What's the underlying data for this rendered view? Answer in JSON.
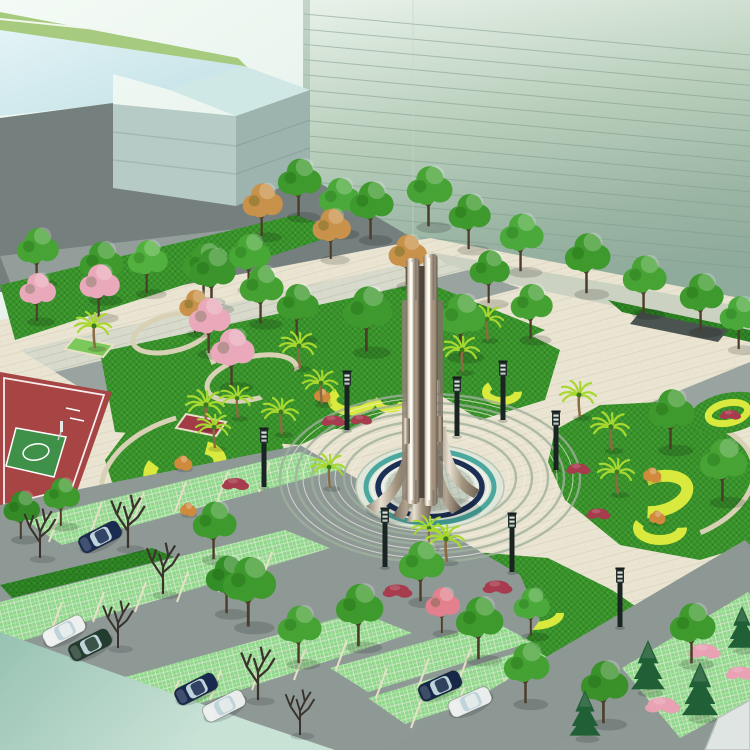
{
  "scene": {
    "type": "architectural-landscape-rendering",
    "view": "aerial isometric",
    "setting": "civic plaza with central stainless-steel spire sculpture, circular paving, swirl flower beds, basketball court, tree-lined street and grass-paver parking"
  },
  "palette": {
    "sky": "#f2faf5",
    "glass_top": "#e6efe8",
    "glass_bottom": "#8fab9b",
    "glass_line": "#7f9b8b",
    "glass_base_band": "#83a08f",
    "pale_roof": "#ddeff2",
    "pale_wall_front": "#b6cac6",
    "pale_wall_side": "#9db3ad",
    "roof_lawn": "#a6cb7f",
    "dark_ground": "#747f7e",
    "road": "#99a4a0",
    "plaza_cream": "#eae5d2",
    "sidewalk": "#d8dbcc",
    "lawn": "#3a922c",
    "hedge": "#2d8224",
    "yellow_swirl": "#d9e93e",
    "red_flowers": "#a63c4e",
    "orange_shrub": "#d08a3c",
    "pink_blossom": "#eaa9ba",
    "palm_frond": "#a7d830",
    "court_red": "#a74444",
    "court_green": "#3f9048",
    "court_line": "#ffffff",
    "grass_paver": "#90d88c",
    "stall_line": "#e6e1c6",
    "teal_wash": "#9ecbb6",
    "ring_line": "#9fb09c",
    "platform_teal": "#4aa89e",
    "platform_navy": "#1c2f55",
    "metal_light": "#faf6ec",
    "metal_dark": "#5a5144",
    "car_navy": "#1a2b52",
    "car_white": "#edf0ef",
    "car_green": "#223c2e",
    "lamp_dark": "#1a2422",
    "stone_path": "#d9d1b6"
  },
  "objects": {
    "sculpture": "stainless-steel spire sculpture on circular platform",
    "plaza": "concentric ring paved plaza",
    "court": "basketball court",
    "parking": "grass-paver parking stalls with cars",
    "buildings": [
      "low glass office block",
      "green curtain-wall tower"
    ]
  },
  "rings": {
    "cx": 430,
    "cy": 478,
    "radii": [
      150,
      134,
      118,
      102,
      86
    ],
    "squash": 0.56
  },
  "glass_lines": {
    "count": 15,
    "x1": 304,
    "x2": 750,
    "y_start": 14,
    "y_step": 15.2,
    "drop": 41
  },
  "instances": [
    [
      "treeG",
      38,
      282,
      1.15,
      "#46a334"
    ],
    [
      "treeG",
      102,
      298,
      1.2,
      "#3f9a2e"
    ],
    [
      "treeG",
      148,
      292,
      1.1,
      "#52b13e"
    ],
    [
      "treeG",
      205,
      300,
      1.2,
      "#3f9a2e"
    ],
    [
      "treeG",
      250,
      288,
      1.15,
      "#48a836"
    ],
    [
      "treeG",
      213,
      307,
      1.25,
      "#3c952c"
    ],
    [
      "treeG",
      262,
      322,
      1.2,
      "#44a132"
    ],
    [
      "treeG",
      298,
      338,
      1.15,
      "#3f9a2e"
    ],
    [
      "treeG",
      300,
      215,
      1.2,
      "#3f9a2e"
    ],
    [
      "treeG",
      340,
      232,
      1.15,
      "#4aa93a"
    ],
    [
      "treeG",
      372,
      238,
      1.2,
      "#3f9a2e"
    ],
    [
      "treeG",
      430,
      225,
      1.25,
      "#46a334"
    ],
    [
      "treeG",
      470,
      248,
      1.15,
      "#3f9a2e"
    ],
    [
      "treeG",
      522,
      270,
      1.2,
      "#4aa93a"
    ],
    [
      "treeG",
      588,
      292,
      1.25,
      "#3f9a2e"
    ],
    [
      "treeG",
      645,
      312,
      1.2,
      "#46a334"
    ],
    [
      "treeG",
      702,
      330,
      1.2,
      "#3f9a2e"
    ],
    [
      "treeG",
      740,
      348,
      1.1,
      "#4aa93a"
    ],
    [
      "treeO",
      263,
      235,
      1.1
    ],
    [
      "treeO",
      332,
      258,
      1.05
    ],
    [
      "treeO",
      408,
      284,
      1.05
    ],
    [
      "treeO",
      196,
      332,
      0.9
    ],
    [
      "treeP",
      38,
      320,
      1.0
    ],
    [
      "treeP",
      100,
      316,
      1.1
    ],
    [
      "treeP",
      210,
      352,
      1.15
    ],
    [
      "treeP",
      233,
      385,
      1.2
    ],
    [
      "treeG",
      368,
      350,
      1.35,
      "#3e9a2f"
    ],
    [
      "treeG",
      462,
      355,
      1.3,
      "#46a334"
    ],
    [
      "treeG",
      490,
      302,
      1.1,
      "#3f9a2e"
    ],
    [
      "treeG",
      532,
      338,
      1.15,
      "#44a132"
    ],
    [
      "treeG",
      672,
      448,
      1.25,
      "#3f9a2e"
    ],
    [
      "treeG",
      724,
      500,
      1.3,
      "#46a334"
    ],
    [
      "treeG",
      22,
      538,
      1.0,
      "#358a28"
    ],
    [
      "treeG",
      62,
      525,
      1.0,
      "#3f9a2e"
    ],
    [
      "palm",
      95,
      348,
      1.0
    ],
    [
      "palm",
      300,
      368,
      1.0
    ],
    [
      "palm",
      463,
      372,
      1.0
    ],
    [
      "palm",
      488,
      340,
      0.95
    ],
    [
      "palm",
      207,
      428,
      1.05
    ],
    [
      "palm",
      282,
      434,
      1.0
    ],
    [
      "palm",
      322,
      404,
      0.95
    ],
    [
      "palm",
      238,
      418,
      0.9
    ],
    [
      "palm",
      580,
      417,
      1.0
    ],
    [
      "palm",
      612,
      450,
      1.05
    ],
    [
      "palm",
      618,
      494,
      1.0
    ],
    [
      "palm",
      215,
      448,
      0.95
    ],
    [
      "palm",
      330,
      488,
      0.95
    ],
    [
      "palm",
      430,
      548,
      0.9
    ],
    [
      "palm",
      447,
      562,
      1.05
    ],
    [
      "shrub",
      322,
      400,
      1,
      null
    ],
    [
      "shrub",
      183,
      468,
      1.1,
      null
    ],
    [
      "shrub",
      188,
      514,
      1,
      null
    ],
    [
      "shrub",
      652,
      480,
      1.1,
      null
    ],
    [
      "shrub",
      657,
      522,
      1,
      null
    ],
    [
      "fl",
      235,
      483,
      1,
      null
    ],
    [
      "fl",
      333,
      420,
      0.9,
      null
    ],
    [
      "fl",
      361,
      419,
      0.8,
      null
    ],
    [
      "fl",
      397,
      590,
      1.1,
      null
    ],
    [
      "fl",
      497,
      586,
      1.1,
      null
    ],
    [
      "fl",
      578,
      468,
      0.9,
      null
    ],
    [
      "fl",
      598,
      513,
      0.9,
      null
    ],
    [
      "fl",
      730,
      414,
      0.8,
      null
    ],
    [
      "flP",
      662,
      704,
      1.3
    ],
    [
      "flP",
      704,
      650,
      1.2
    ],
    [
      "flP",
      740,
      672,
      1.1
    ],
    [
      "lamp",
      347,
      430,
      1
    ],
    [
      "lamp",
      264,
      487,
      1
    ],
    [
      "lamp",
      457,
      436,
      1
    ],
    [
      "lamp",
      503,
      420,
      1
    ],
    [
      "lamp",
      385,
      567,
      1
    ],
    [
      "lamp",
      512,
      572,
      1
    ],
    [
      "lamp",
      556,
      470,
      1
    ],
    [
      "lamp",
      620,
      627,
      1
    ],
    [
      "treeG",
      215,
      558,
      1.2,
      "#3f9a2e"
    ],
    [
      "treeG",
      228,
      612,
      1.2,
      "#348e28"
    ],
    [
      "treeG",
      250,
      625,
      1.45,
      "#3f9a2e"
    ],
    [
      "treeG",
      300,
      662,
      1.2,
      "#46a334"
    ],
    [
      "treeG",
      360,
      645,
      1.3,
      "#3f9a2e"
    ],
    [
      "treeG",
      422,
      600,
      1.25,
      "#46a334"
    ],
    [
      "treeG",
      480,
      658,
      1.3,
      "#3f9a2e"
    ],
    [
      "treeG",
      527,
      702,
      1.25,
      "#44a132"
    ],
    [
      "treeG",
      532,
      635,
      1.0,
      "#4aa93a"
    ],
    [
      "treeG",
      605,
      722,
      1.3,
      "#3a9129"
    ],
    [
      "treeG",
      693,
      662,
      1.25,
      "#3f9a2e"
    ],
    [
      "treeP",
      443,
      632,
      0.95,
      "#e2808e"
    ],
    [
      "treeB",
      40,
      558,
      1.3
    ],
    [
      "treeB",
      128,
      548,
      1.4
    ],
    [
      "treeB",
      163,
      594,
      1.35
    ],
    [
      "treeB",
      118,
      648,
      1.25
    ],
    [
      "treeB",
      258,
      700,
      1.4
    ],
    [
      "treeB",
      300,
      735,
      1.2
    ],
    [
      "conif",
      648,
      692,
      1.3
    ],
    [
      "conif",
      700,
      718,
      1.4
    ],
    [
      "conif",
      585,
      738,
      1.2
    ],
    [
      "conif",
      742,
      650,
      1.1
    ],
    [
      "car",
      100,
      537,
      1.0,
      "#1a2b52",
      -27
    ],
    [
      "car",
      64,
      631,
      1.0,
      "#edf0ef",
      -27
    ],
    [
      "car",
      90,
      645,
      1.0,
      "#223c2e",
      -27
    ],
    [
      "car",
      196,
      689,
      1.0,
      "#17294e",
      -27
    ],
    [
      "car",
      224,
      706,
      1.0,
      "#e9edec",
      -27
    ],
    [
      "car",
      440,
      686,
      1.0,
      "#152847",
      -24
    ],
    [
      "car",
      470,
      702,
      1.0,
      "#e9edec",
      -24
    ]
  ]
}
